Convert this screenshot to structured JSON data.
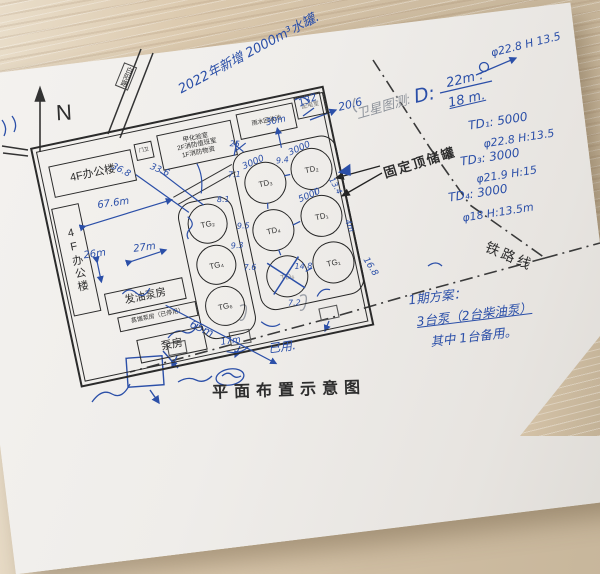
{
  "photo": {
    "caption": "平面布置示意图"
  },
  "colors": {
    "ink": "#2b4fa8",
    "pencil": "#8f949c",
    "print": "#2e2e2e",
    "paper": "#f2f0ed"
  },
  "compass": "N",
  "roads": {
    "road": "白阳路",
    "railway": "铁路线"
  },
  "buildings": {
    "office_top": "4F办公楼",
    "gatehouse": "门卫",
    "lab1": "甲化验室",
    "lab2": "2F消防值班室",
    "lab3": "1F消防物资",
    "rain": "雨水回收池",
    "power": "配电室",
    "office_left": "4F办公楼",
    "oil_pump": "发油泵房",
    "old_pump": "蒸馏泵房（已停用）",
    "pump": "泵房"
  },
  "tank_area": {
    "fixed_roof": "固定顶储罐",
    "left": [
      "TG₂",
      "TG₄",
      "TG₆"
    ],
    "right": [
      "TD₃",
      "TD₂",
      "TD₄",
      "TD₁",
      "TD₆",
      "TG₁"
    ],
    "marks": {
      "td3_cap": "3000",
      "td2_cap": "3000",
      "td1_cap": "5000",
      "power_scribble": "132"
    }
  },
  "dims": {
    "d67": "67.6m",
    "d36": "36.8",
    "d33": "33.6",
    "d26": "26m",
    "d27": "27m",
    "d65": "65m",
    "d30": "30m",
    "d25": "25",
    "d168": "16.8",
    "d148": "14.8",
    "d72": "7.2",
    "d71": "7.1",
    "d94": "9.4",
    "d134": "13.4",
    "d95": "9.5",
    "d81": "8.1",
    "d76": "7.6",
    "d17": "17m",
    "d4": "4m",
    "d93": "9.3",
    "d206": "20.6"
  },
  "notes": {
    "top": "2022年新增 2000m³水罐.",
    "pencil": "卫星图测:",
    "dlab": "D:",
    "dnum": "22m :",
    "dden": "18 m.",
    "spec0": "φ22.8  H 13.5",
    "td1": "TD₁: 5000",
    "td1s": "φ22.8  H:13.5",
    "td3": "TD₃: 3000",
    "td3s": "φ21.9  H:15",
    "td4": "TD₄: 3000",
    "td4s": "φ18  H:13.5m",
    "plan1": "1期方案：",
    "plan2": "3台泵（2台柴油泵）",
    "plan3": "其中 1台备用。",
    "used": "已用."
  }
}
